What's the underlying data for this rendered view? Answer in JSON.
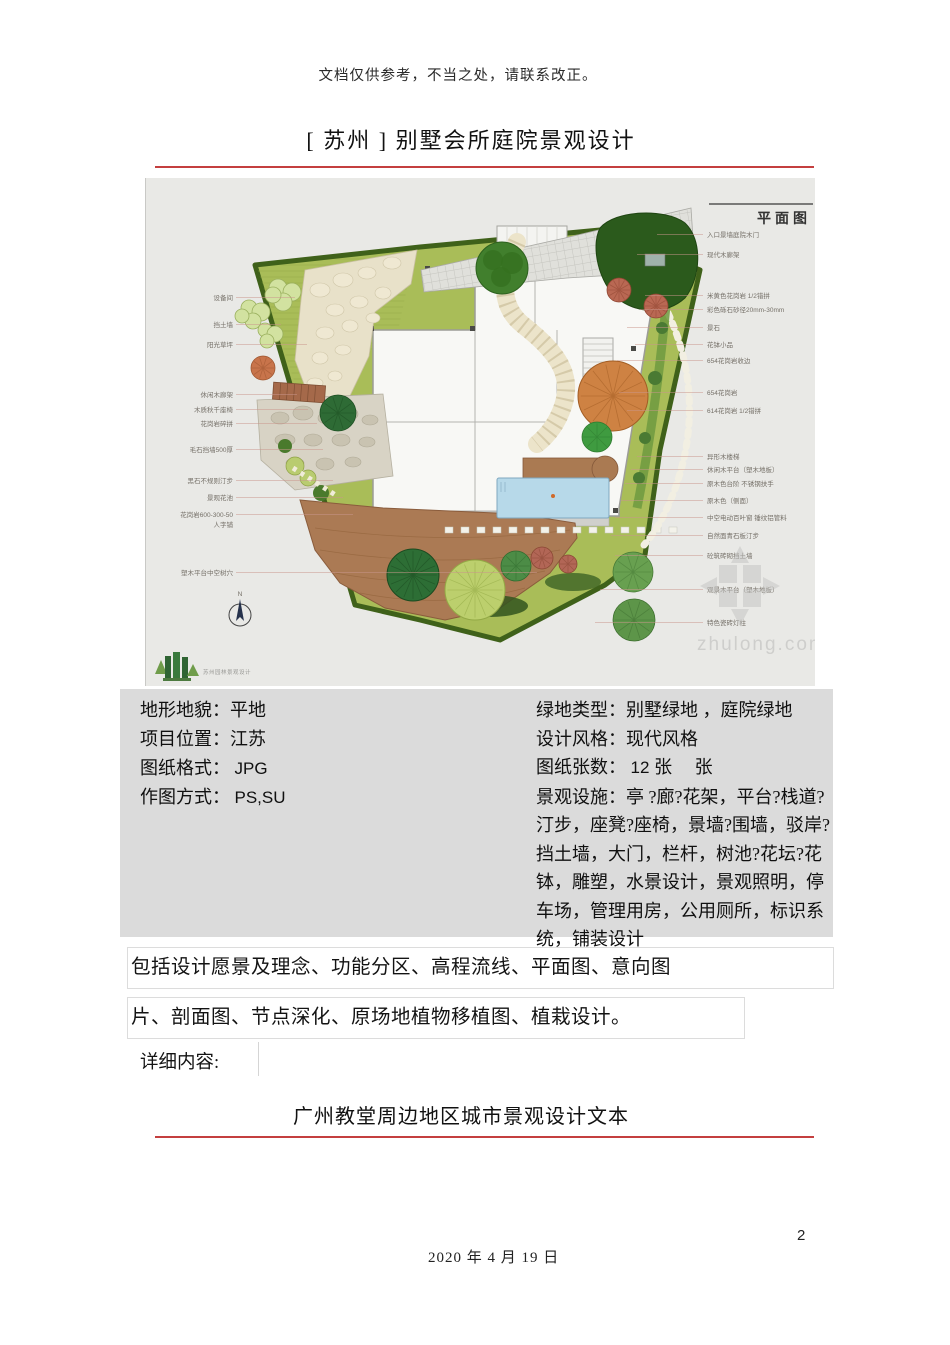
{
  "page": {
    "disclaimer": "文档仅供参考，不当之处，请联系改正。",
    "title_top": "[ 苏州 ] 别墅会所庭院景观设计",
    "title_bottom": "广州教堂周边地区城市景观设计文本",
    "date": "2020 年 4 月 19 日",
    "page_number": "2",
    "accent_red": "#c43f3f"
  },
  "plan": {
    "label": "平面图",
    "compass": "N",
    "watermark": "zhulong.com",
    "logo_text": "苏州园林景观设计",
    "left_annotations": [
      {
        "text": "设备间",
        "y": 122,
        "x2": 150
      },
      {
        "text": "挡土墙",
        "y": 149,
        "x2": 136
      },
      {
        "text": "阳光草坪",
        "y": 169,
        "x2": 162
      },
      {
        "text": "休闲木廊架",
        "y": 219,
        "x2": 152
      },
      {
        "text": "木质秋千座椅",
        "y": 234,
        "x2": 163
      },
      {
        "text": "花岗岩碎拼",
        "y": 248,
        "x2": 172
      },
      {
        "text": "毛石挡墙500厚",
        "y": 274,
        "x2": 178
      },
      {
        "text": "黑石不规则汀步",
        "y": 305,
        "x2": 188
      },
      {
        "text": "景观花池",
        "y": 322,
        "x2": 198
      },
      {
        "text": "花岗岩600-300-50",
        "y": 339,
        "x2": 208
      },
      {
        "text": "人字铺",
        "y": 349,
        "x2": 0
      },
      {
        "text": "塑木平台中空树穴",
        "y": 397,
        "x2": 392
      }
    ],
    "right_annotations": [
      {
        "text": "入口景墙庭院木门",
        "y": 59,
        "x2": 512
      },
      {
        "text": "现代木廊架",
        "y": 79,
        "x2": 492
      },
      {
        "text": "米黄色花岗岩 1/2错拼",
        "y": 120,
        "x2": 500
      },
      {
        "text": "彩色砾石砂径20mm-30mm",
        "y": 134,
        "x2": 495
      },
      {
        "text": "景石",
        "y": 152,
        "x2": 482
      },
      {
        "text": "花钵小品",
        "y": 169,
        "x2": 490
      },
      {
        "text": "654花岗岩收边",
        "y": 185,
        "x2": 472
      },
      {
        "text": "654花岗岩",
        "y": 217,
        "x2": 474
      },
      {
        "text": "614花岗岩 1/2错拼",
        "y": 235,
        "x2": 482
      },
      {
        "text": "异形木楼梯",
        "y": 281,
        "x2": 492
      },
      {
        "text": "休闲木平台（塑木地板）",
        "y": 294,
        "x2": 486
      },
      {
        "text": "原木色台阶 不锈钢扶手",
        "y": 308,
        "x2": 480
      },
      {
        "text": "原木色（侧面）",
        "y": 325,
        "x2": 476
      },
      {
        "text": "中空电动百叶窗 锤纹铝管料",
        "y": 342,
        "x2": 470
      },
      {
        "text": "自然面青石板汀步",
        "y": 360,
        "x2": 466
      },
      {
        "text": "砼筑砖砌挡土墙",
        "y": 380,
        "x2": 470
      },
      {
        "text": "观景木平台（塑木地板）",
        "y": 414,
        "x2": 455
      },
      {
        "text": "特色瓷砖灯柱",
        "y": 447,
        "x2": 450
      }
    ]
  },
  "info": {
    "left": [
      {
        "label": "地形地貌：",
        "value": "平地"
      },
      {
        "label": "项目位置：",
        "value": "江苏"
      },
      {
        "label": "图纸格式：",
        "value": "JPG"
      },
      {
        "label": "作图方式：",
        "value": "PS,SU"
      }
    ],
    "right": [
      {
        "label": "绿地类型：",
        "value": "别墅绿地 ，庭院绿地"
      },
      {
        "label": "设计风格：",
        "value": "现代风格"
      },
      {
        "label": "图纸张数：",
        "value_num": "12 ",
        "value_suffix": "张　 张"
      },
      {
        "label": "景观设施：",
        "value": "亭 ?廊?花架，平台?栈道?汀步，座凳?座椅，景墙?围墙，驳岸?挡土墙，大门，栏杆，树池?花坛?花钵，雕塑，水景设计，景观照明，停车场，管理用房，公用厕所，标识系统，铺装设计"
      }
    ]
  },
  "body": {
    "line1": "包括设计愿景及理念、功能分区、高程流线、平面图、意向图",
    "line2": "片、剖面图、节点深化、原场地植物移植图、植栽设计。",
    "detail": "详细内容:"
  }
}
